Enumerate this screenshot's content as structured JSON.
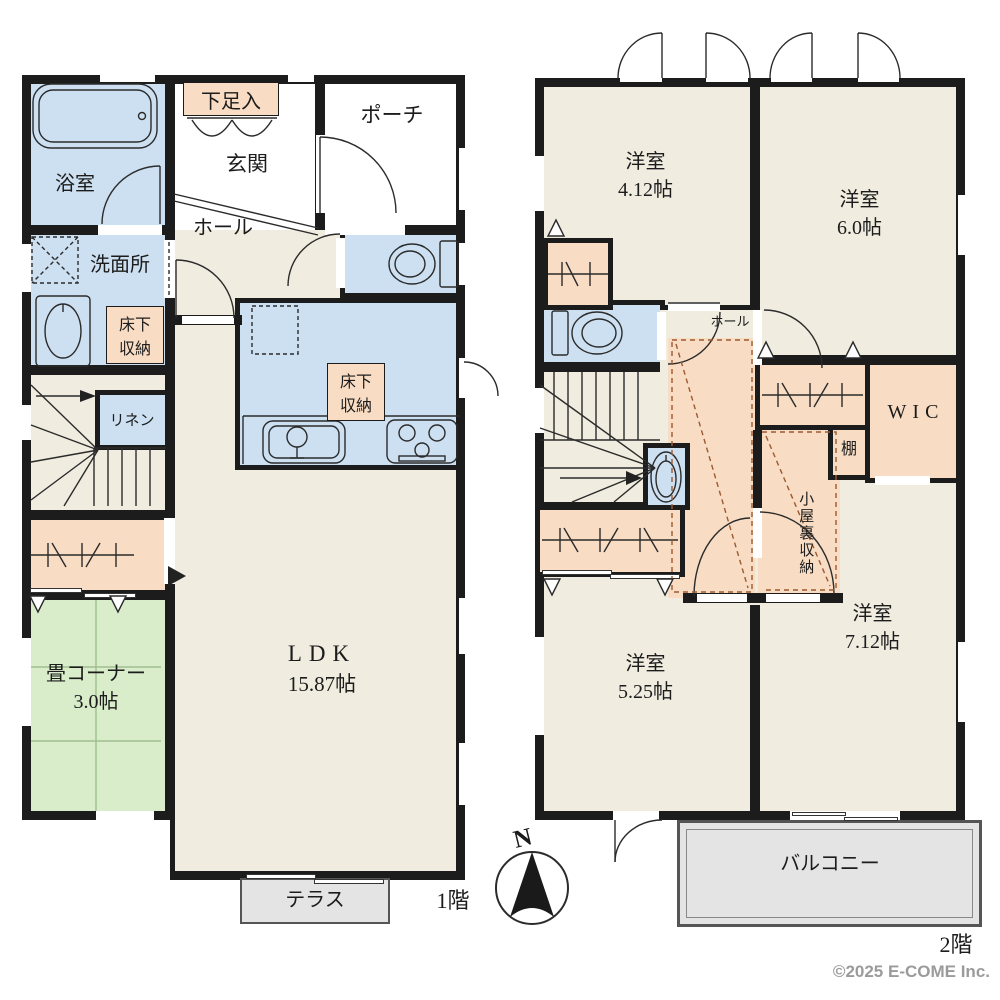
{
  "floor1": {
    "floor_label": "1階",
    "bath": "浴室",
    "shoe_storage": "下足入",
    "entrance": "玄関",
    "porch": "ポーチ",
    "hall": "ホール",
    "washroom": "洗面所",
    "underfloor_storage_washroom": "床下収納",
    "underfloor_storage_kitchen": "床下収納",
    "linen": "リネン",
    "tatami_name": "畳コーナー",
    "tatami_size": "3.0帖",
    "ldk_name": "LDK",
    "ldk_size": "15.87帖",
    "terrace": "テラス"
  },
  "floor2": {
    "floor_label": "2階",
    "room_nw_name": "洋室",
    "room_nw_size": "4.12帖",
    "room_ne_name": "洋室",
    "room_ne_size": "6.0帖",
    "room_sw_name": "洋室",
    "room_sw_size": "5.25帖",
    "room_se_name": "洋室",
    "room_se_size": "7.12帖",
    "hall": "ホール",
    "wic": "WIC",
    "shelf": "棚",
    "attic_storage": "小屋裏収納",
    "balcony": "バルコニー"
  },
  "compass": {
    "north": "N"
  },
  "footer": {
    "copyright": "©2025 E-COME Inc."
  },
  "colors": {
    "wall": "#1c1c1c",
    "floor": "#f0ecdf",
    "wet_area": "#cde0f1",
    "storage": "#f8dcc3",
    "tatami": "#d9edca",
    "outdoor": "#e4e4e4"
  }
}
